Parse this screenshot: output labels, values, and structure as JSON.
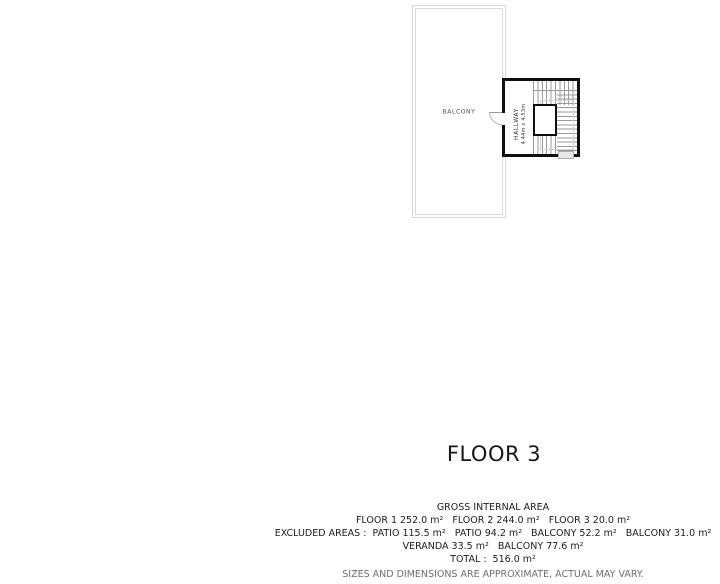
{
  "plan": {
    "floor_title": "FLOOR 3",
    "rooms": {
      "balcony": {
        "label": "BALCONY"
      },
      "hallway": {
        "label": "HALLWAY",
        "dimensions": "4.44m x 4.53m"
      }
    }
  },
  "area_summary": {
    "heading": "GROSS INTERNAL AREA",
    "lines": [
      "FLOOR 1 252.0 m²   FLOOR 2 244.0 m²   FLOOR 3 20.0 m²",
      "EXCLUDED AREAS :  PATIO 115.5 m²   PATIO 94.2 m²   BALCONY 52.2 m²   BALCONY 31.0 m²",
      "VERANDA 33.5 m²   BALCONY 77.6 m²"
    ],
    "total": "TOTAL :  516.0 m²",
    "disclaimer": "SIZES AND DIMENSIONS ARE APPROXIMATE, ACTUAL MAY VARY."
  },
  "colors": {
    "wall_heavy": "#0f0f0f",
    "wall_light": "#d7d7d7",
    "stair_tread": "#9a9a9a",
    "text_main": "#1c1c1c",
    "text_disclaimer": "#6e6e6e"
  }
}
